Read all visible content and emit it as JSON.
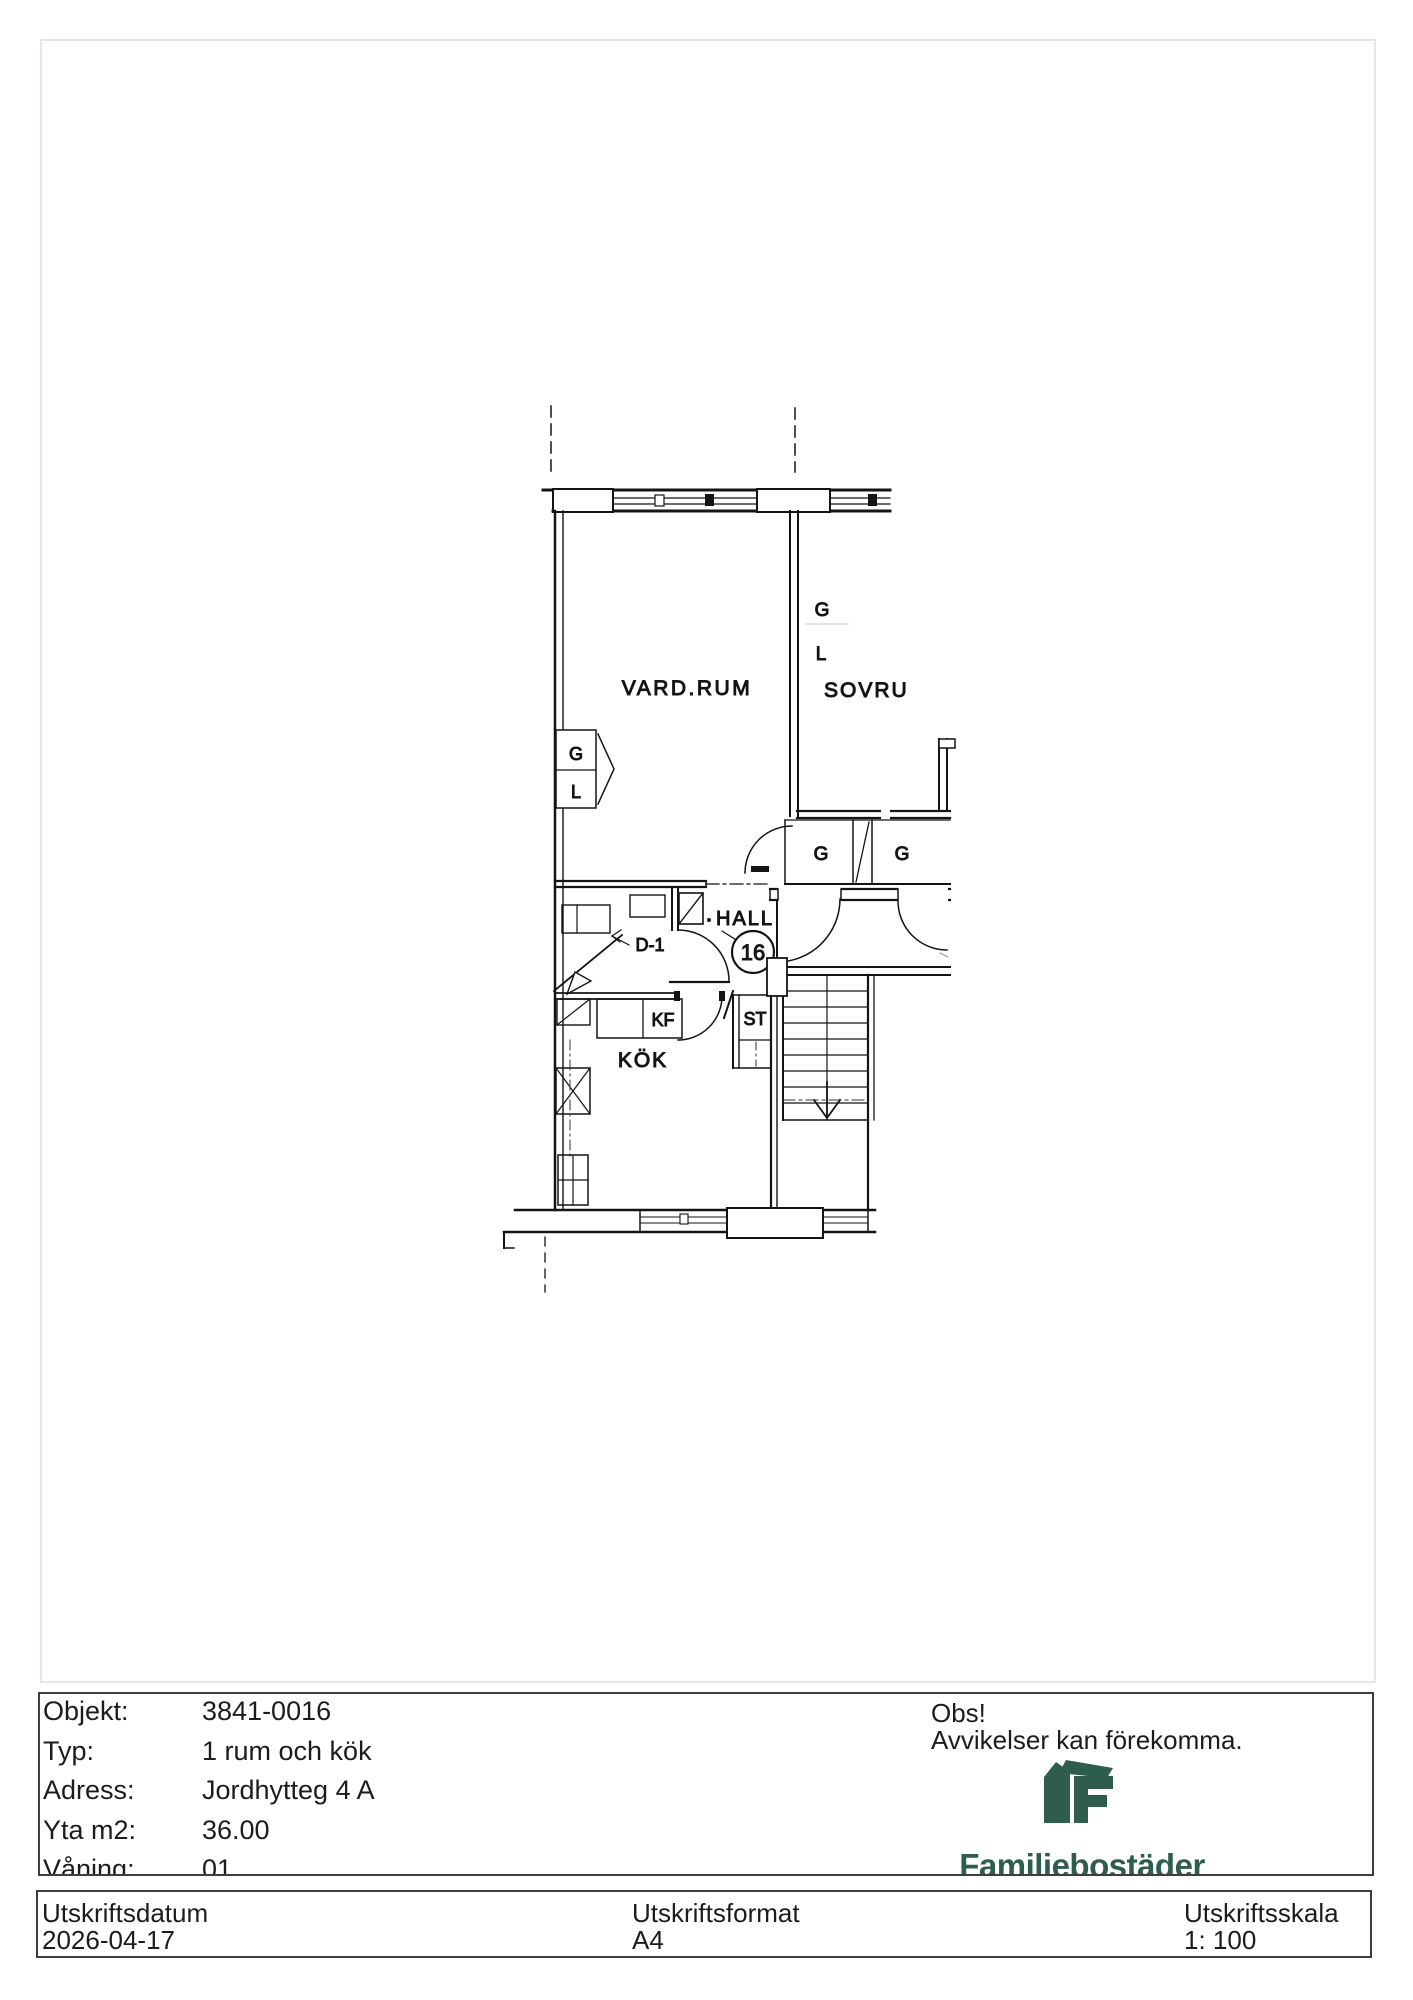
{
  "plan": {
    "rooms": {
      "living": "VARD.RUM",
      "bedroom": "SOVRU",
      "hall": "HALL",
      "kitchen": "KÖK"
    },
    "labels": {
      "g_bedroom": "G",
      "l_bedroom": "L",
      "g_wardrobe": "G",
      "l_wardrobe": "L",
      "g_closet_left": "G",
      "g_closet_right": "G",
      "fridge_freezer": "KF",
      "storage": "ST",
      "door": "D-1",
      "unit_number": "16"
    }
  },
  "info_table": {
    "rows": [
      {
        "label": "Objekt:",
        "value": "3841-0016"
      },
      {
        "label": "Typ:",
        "value": "1 rum och kök"
      },
      {
        "label": "Adress:",
        "value": "Jordhytteg 4 A"
      },
      {
        "label": "Yta m2:",
        "value": "36.00"
      },
      {
        "label": "Våning:",
        "value": "01"
      }
    ]
  },
  "notice": {
    "title": "Obs!",
    "text": "Avvikelser kan förekomma."
  },
  "brand": {
    "name": "Familjebostäder",
    "color": "#2e5d4c"
  },
  "footer": {
    "columns": [
      {
        "label": "Utskriftsdatum",
        "value": "2026-04-17"
      },
      {
        "label": "Utskriftsformat",
        "value": "A4"
      },
      {
        "label": "Utskriftsskala",
        "value": "1: 100"
      }
    ]
  }
}
